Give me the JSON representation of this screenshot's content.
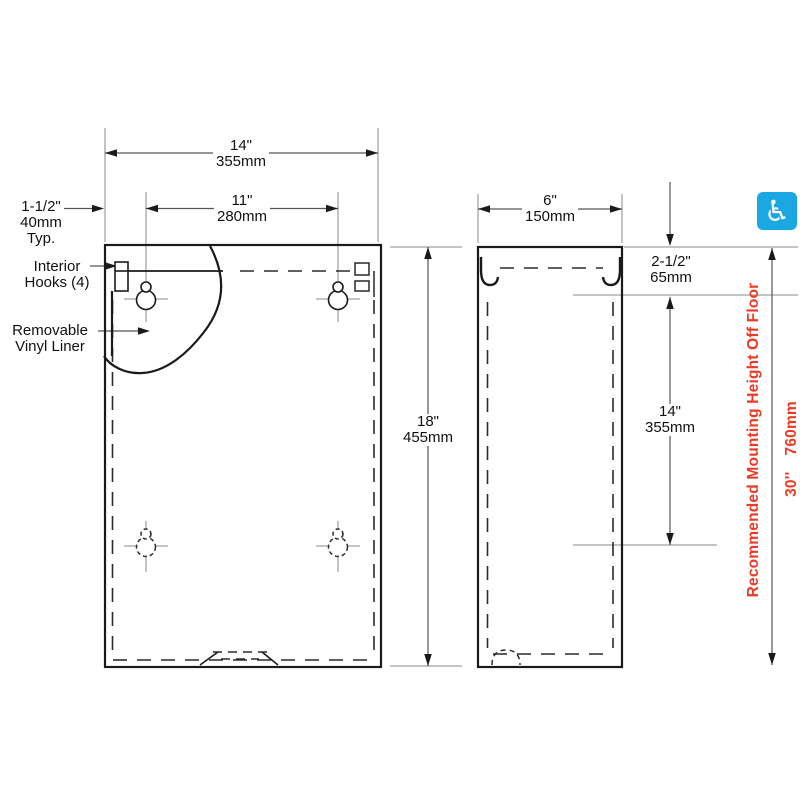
{
  "title": "Waste receptacle mounting dimension drawing",
  "labels": {
    "width": {
      "in": "14\"",
      "mm": "355mm"
    },
    "hole_spacing_h": {
      "in": "11\"",
      "mm": "280mm"
    },
    "edge_offset": {
      "in": "1-1/2\"",
      "mm": "40mm",
      "suffix": "Typ."
    },
    "interior_hooks": {
      "line1": "Interior",
      "line2": "Hooks (4)"
    },
    "vinyl_liner": {
      "line1": "Removable",
      "line2": "Vinyl Liner"
    },
    "height": {
      "in": "18\"",
      "mm": "455mm"
    },
    "depth": {
      "in": "6\"",
      "mm": "150mm"
    },
    "top_offset": {
      "in": "2-1/2\"",
      "mm": "65mm"
    },
    "hole_spacing_v": {
      "in": "14\"",
      "mm": "355mm"
    },
    "mounting_note": "Recommended Mounting Height Off Floor",
    "mounting_height_in": "30''",
    "mounting_height_mm": "760mm"
  },
  "icons": {
    "accessibility": "wheelchair-symbol",
    "accessibility_glyph": "♿"
  },
  "colors": {
    "note_red": "#EE3A24",
    "icon_blue": "#1BA7E1",
    "line_black": "#1a1a1a",
    "reference_gray": "#8a8a8a",
    "dimension_gray": "#555555"
  }
}
